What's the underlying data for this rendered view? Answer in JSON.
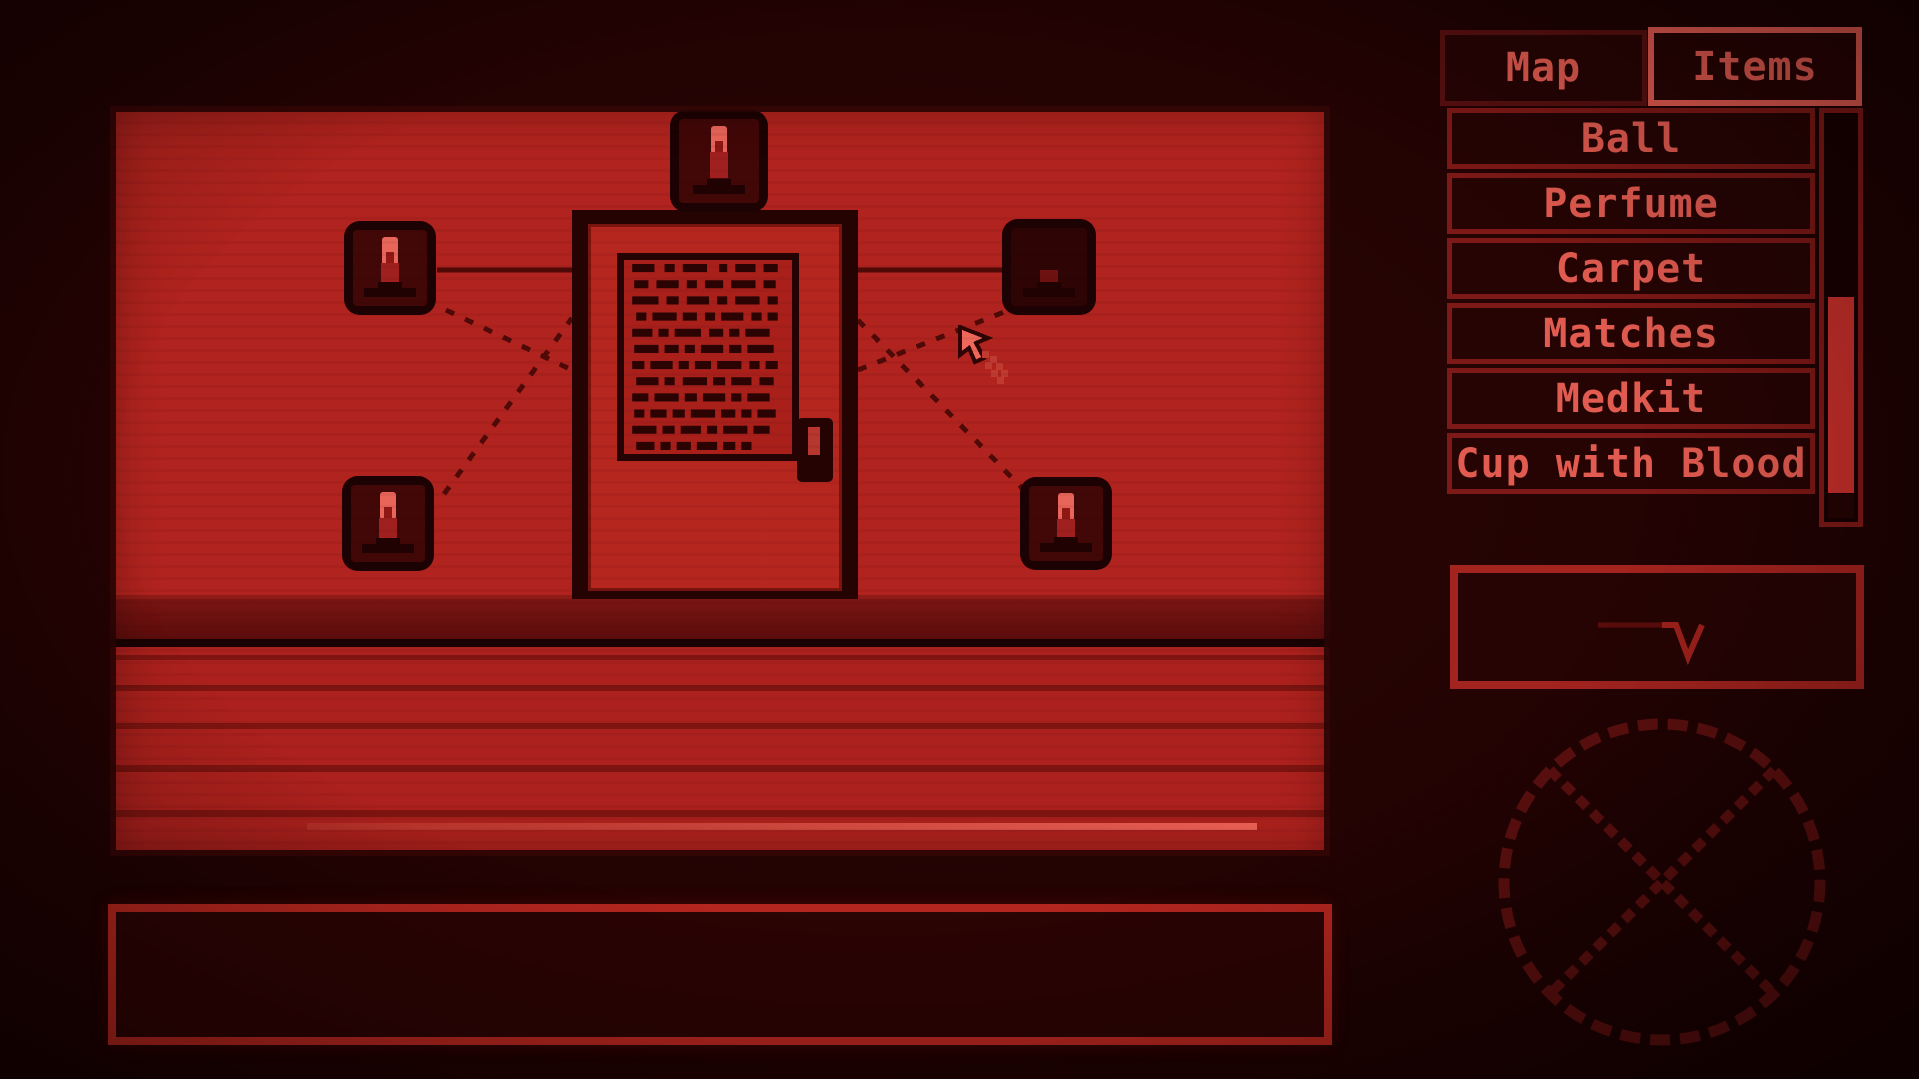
{
  "colors": {
    "accent": "#e25b50",
    "wall": "#b0231e",
    "floor": "#ac211d",
    "stripe": "#7e1511",
    "note": "#a9201b",
    "flame": "#e8655a",
    "frame-dark": "#1c0202",
    "line": "#4f0a08",
    "tab-idle-border": "#571010",
    "row-border": "#7d1916",
    "thumb": "#c8302b",
    "bright-border": "#b3261f",
    "circle": "#5c100f"
  },
  "sidebar": {
    "tabs": [
      {
        "label": "Map",
        "active": false
      },
      {
        "label": "Items",
        "active": true
      }
    ],
    "items": [
      {
        "label": "Ball"
      },
      {
        "label": "Perfume"
      },
      {
        "label": "Carpet"
      },
      {
        "label": "Matches"
      },
      {
        "label": "Medkit"
      },
      {
        "label": "Cup with Blood"
      }
    ]
  },
  "scene": {
    "candles": [
      {
        "id": "top",
        "lit": true
      },
      {
        "id": "upper-left",
        "lit": true
      },
      {
        "id": "upper-right",
        "lit": false
      },
      {
        "id": "lower-left",
        "lit": true
      },
      {
        "id": "lower-right",
        "lit": true
      }
    ]
  },
  "message_box": {
    "text": ""
  }
}
